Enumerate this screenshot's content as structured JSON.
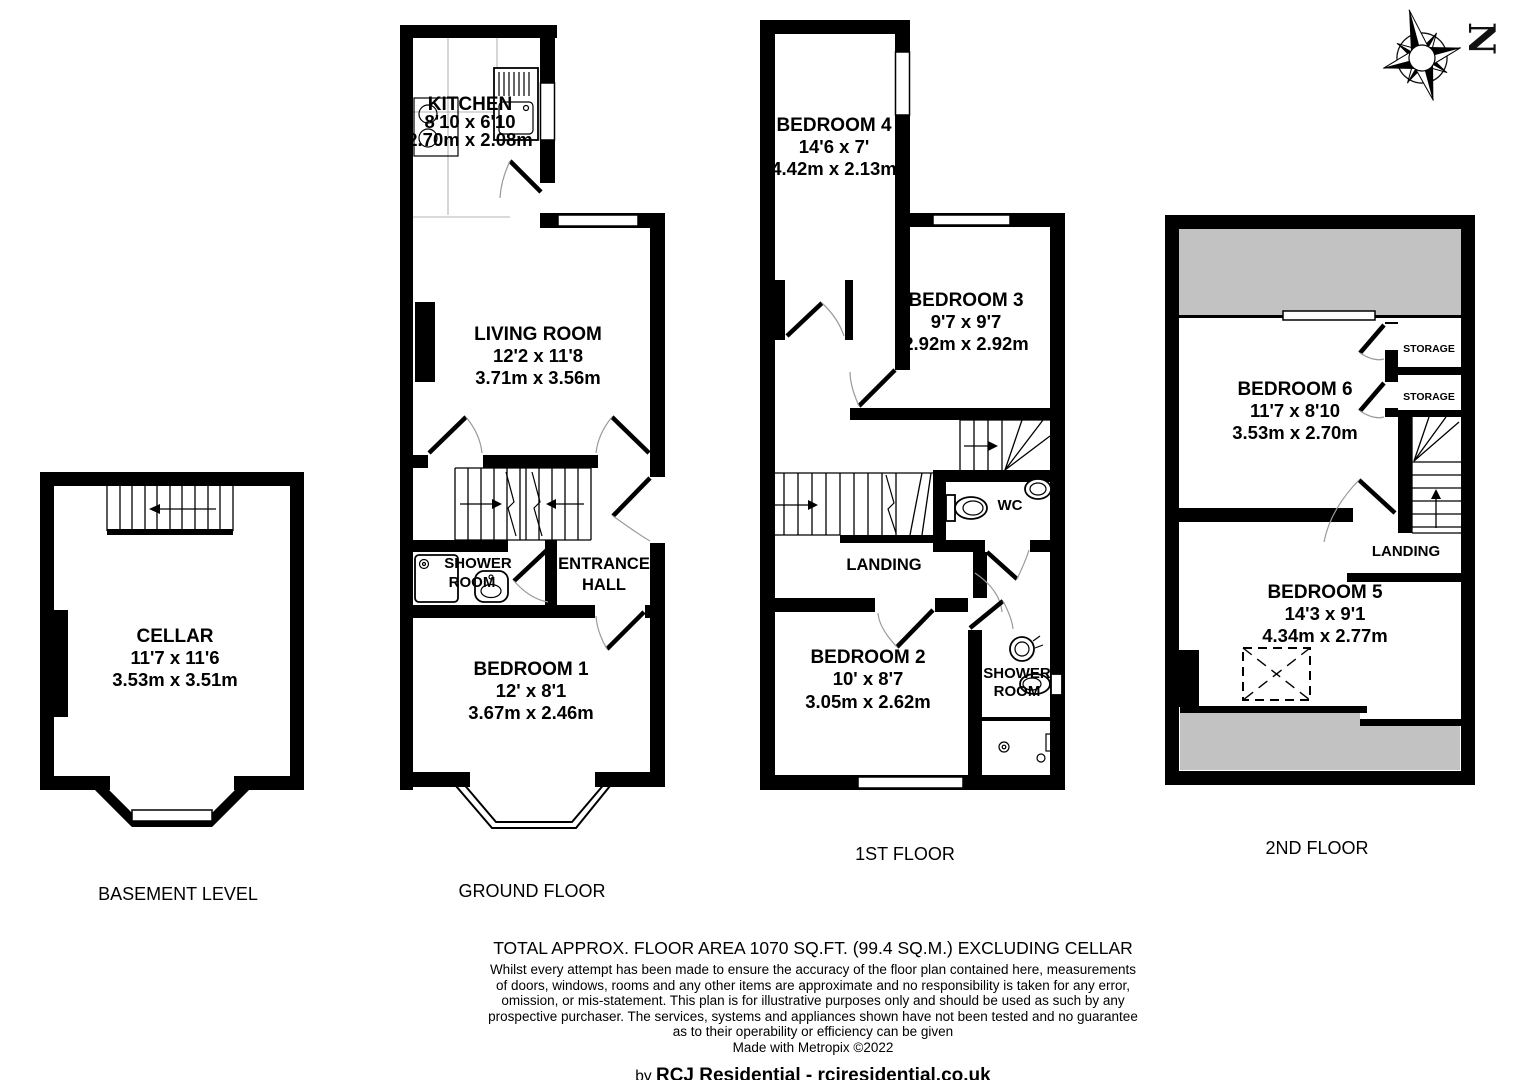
{
  "compass": {
    "letter": "N"
  },
  "colors": {
    "wall": "#000000",
    "restricted_area": "#c2c2c2"
  },
  "floors": {
    "basement": {
      "label": "BASEMENT LEVEL",
      "rooms": {
        "cellar": {
          "name": "CELLAR",
          "imperial": "11'7 x 11'6",
          "metric": "3.53m x 3.51m"
        }
      }
    },
    "ground": {
      "label": "GROUND FLOOR",
      "rooms": {
        "kitchen": {
          "name": "KITCHEN",
          "imperial": "8'10 x 6'10",
          "metric": "2.70m x 2.08m"
        },
        "living_room": {
          "name": "LIVING ROOM",
          "imperial": "12'2 x 11'8",
          "metric": "3.71m x 3.56m"
        },
        "shower_room": {
          "lines": [
            "SHOWER",
            "ROOM"
          ]
        },
        "entrance_hall": {
          "lines": [
            "ENTRANCE",
            "HALL"
          ]
        },
        "bedroom1": {
          "name": "BEDROOM 1",
          "imperial": "12' x 8'1",
          "metric": "3.67m x 2.46m"
        }
      }
    },
    "first": {
      "label": "1ST FLOOR",
      "rooms": {
        "bedroom4": {
          "name": "BEDROOM 4",
          "imperial": "14'6 x 7'",
          "metric": "4.42m x 2.13m"
        },
        "bedroom3": {
          "name": "BEDROOM 3",
          "imperial": "9'7 x 9'7",
          "metric": "2.92m x 2.92m"
        },
        "wc": {
          "name": "WC"
        },
        "landing": {
          "name": "LANDING"
        },
        "bedroom2": {
          "name": "BEDROOM 2",
          "imperial": "10' x 8'7",
          "metric": "3.05m x 2.62m"
        },
        "shower_room": {
          "lines": [
            "SHOWER",
            "ROOM"
          ]
        }
      }
    },
    "second": {
      "label": "2ND FLOOR",
      "rooms": {
        "bedroom6": {
          "name": "BEDROOM 6",
          "imperial": "11'7 x 8'10",
          "metric": "3.53m x 2.70m"
        },
        "storages": [
          "STORAGE",
          "STORAGE"
        ],
        "landing": {
          "name": "LANDING"
        },
        "bedroom5": {
          "name": "BEDROOM 5",
          "imperial": "14'3 x 9'1",
          "metric": "4.34m x 2.77m"
        }
      }
    }
  },
  "footer": {
    "total_area": "TOTAL APPROX. FLOOR AREA 1070 SQ.FT. (99.4 SQ.M.) EXCLUDING CELLAR",
    "disclaimer_lines": [
      "Whilst every attempt has been made to ensure the accuracy of the floor plan contained here, measurements",
      "of doors, windows, rooms and any other items are approximate and no responsibility is taken for any error,",
      "omission, or mis-statement. This plan is for illustrative purposes only and should be used as such by any",
      "prospective purchaser. The services, systems and appliances shown have not been tested and no guarantee",
      "as to their operability or efficiency can be given"
    ],
    "made_with": "Made with Metropix ©2022",
    "credit_prefix": "by ",
    "credit": "RCJ Residential - rcjresidential.co.uk"
  }
}
